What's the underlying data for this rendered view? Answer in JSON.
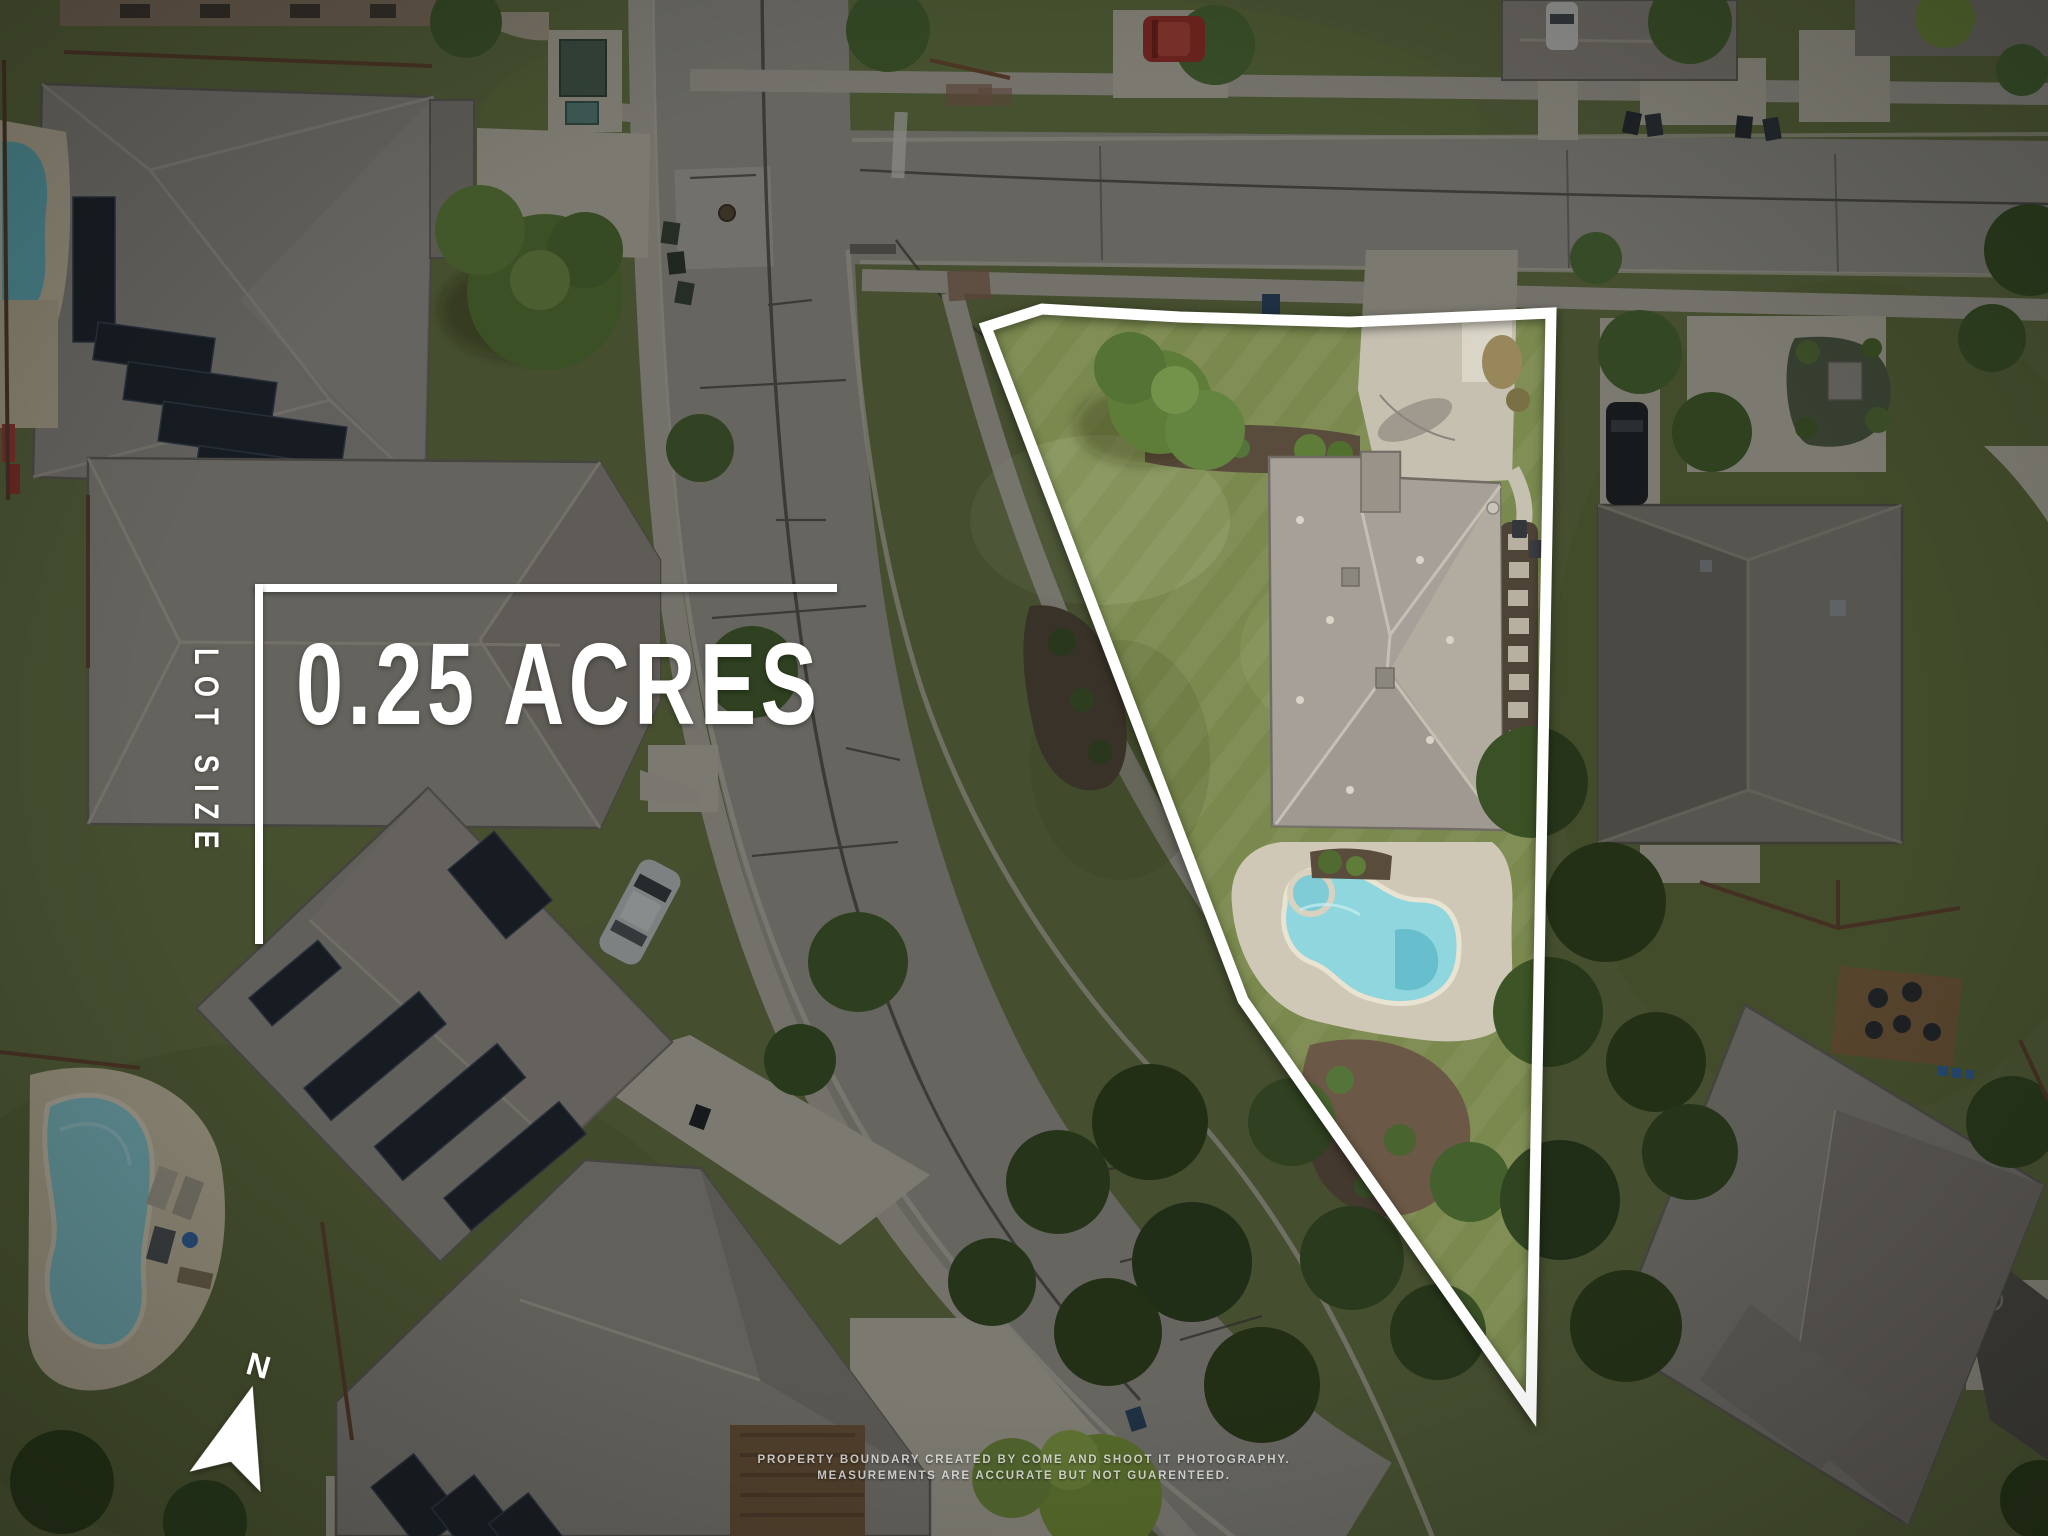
{
  "overlay": {
    "lot_size": {
      "label": "LOT SIZE",
      "value": "0.25 ACRES"
    },
    "compass": {
      "label": "N",
      "icon": "north-arrow-icon"
    },
    "disclaimer": {
      "line1": "PROPERTY BOUNDARY CREATED BY COME AND SHOOT IT PHOTOGRAPHY.",
      "line2": "MEASUREMENTS ARE ACCURATE BUT NOT GUARENTEED."
    }
  },
  "palette": {
    "boundary": "#ffffff",
    "dim": "rgba(4,7,9,0.38)",
    "grass-base": "#6d7a47",
    "lot-grass": "#7a894e",
    "road": "#a29e97",
    "concrete": "#c6c0b1",
    "sidewalk": "#b7b2a6",
    "roof-light": "#a6a099",
    "roof-dark": "#8a857c",
    "pool-water": "#8fd6de",
    "tree-dark": "#36491f",
    "tree-bright": "#5d7d38",
    "mulch": "#5a4c3d",
    "deck-wood": "#8a6a45",
    "car-red": "#a8352c"
  }
}
